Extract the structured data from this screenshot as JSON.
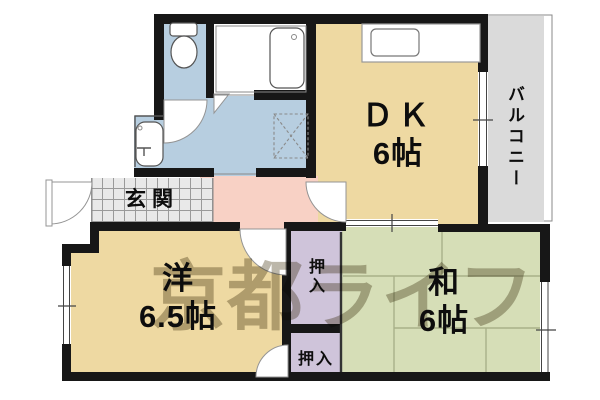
{
  "watermark": "京都ライフ",
  "labels": {
    "dk_name": "ＤＫ",
    "dk_size": "6帖",
    "balcony": "バルコニー",
    "entrance": "玄関",
    "western_name": "洋",
    "western_size": "6.5帖",
    "japanese_name": "和",
    "japanese_size": "6帖",
    "closet_upper": "押入",
    "closet_lower": "押入"
  },
  "rooms": [
    {
      "id": "dk",
      "label": "ＤＫ 6帖",
      "type": "dining-kitchen"
    },
    {
      "id": "western",
      "label": "洋 6.5帖",
      "type": "western-room"
    },
    {
      "id": "japanese",
      "label": "和 6帖",
      "type": "japanese-room"
    },
    {
      "id": "balcony",
      "label": "バルコニー",
      "type": "balcony"
    },
    {
      "id": "entrance",
      "label": "玄関",
      "type": "entrance"
    },
    {
      "id": "closet-upper",
      "label": "押入",
      "type": "closet"
    },
    {
      "id": "closet-lower",
      "label": "押入",
      "type": "closet"
    },
    {
      "id": "washroom",
      "label": "",
      "type": "washroom"
    },
    {
      "id": "toilet",
      "label": "",
      "type": "toilet"
    },
    {
      "id": "bath",
      "label": "",
      "type": "bath"
    }
  ],
  "fixtures": [
    "toilet",
    "bathtub",
    "washbasin",
    "washing-machine-pan",
    "kitchen-counter",
    "kitchen-sink"
  ],
  "colors": {
    "room_tan": "#eed9a2",
    "room_blue": "#b7cee0",
    "room_pink": "#f8d1c5",
    "room_green": "#d6deb7",
    "closet_purple": "#cfc4da",
    "balcony_gray": "#dadada",
    "tile_gray": "#e9e9e9",
    "wall_black": "#171717",
    "tatami_line": "#a9b089",
    "watermark_gray": "rgba(122,112,86,0.5)"
  }
}
